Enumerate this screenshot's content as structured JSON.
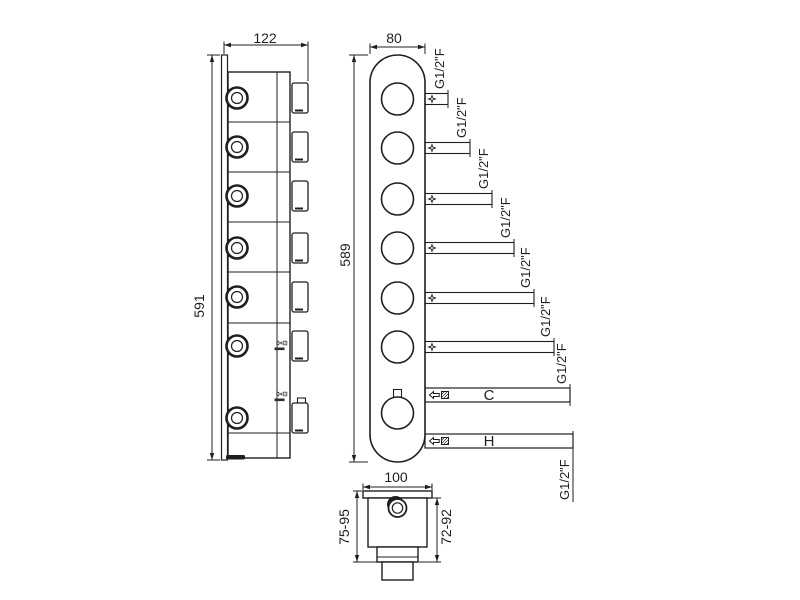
{
  "side_view": {
    "width_dim": "122",
    "height_dim": "591"
  },
  "front_view": {
    "width_dim": "80",
    "height_dim": "589",
    "outlet_labels": [
      "G1/2\"F",
      "G1/2\"F",
      "G1/2\"F",
      "G1/2\"F",
      "G1/2\"F",
      "G1/2\"F"
    ],
    "cold": {
      "label": "C",
      "thread": "G1/2\"F"
    },
    "hot": {
      "label": "H",
      "thread": "G1/2\"F"
    }
  },
  "bottom_view": {
    "width_dim": "100",
    "depth_range_left": "75-95",
    "depth_range_right": "72-92"
  },
  "colors": {
    "line": "#1f1f1f",
    "background": "#ffffff"
  }
}
